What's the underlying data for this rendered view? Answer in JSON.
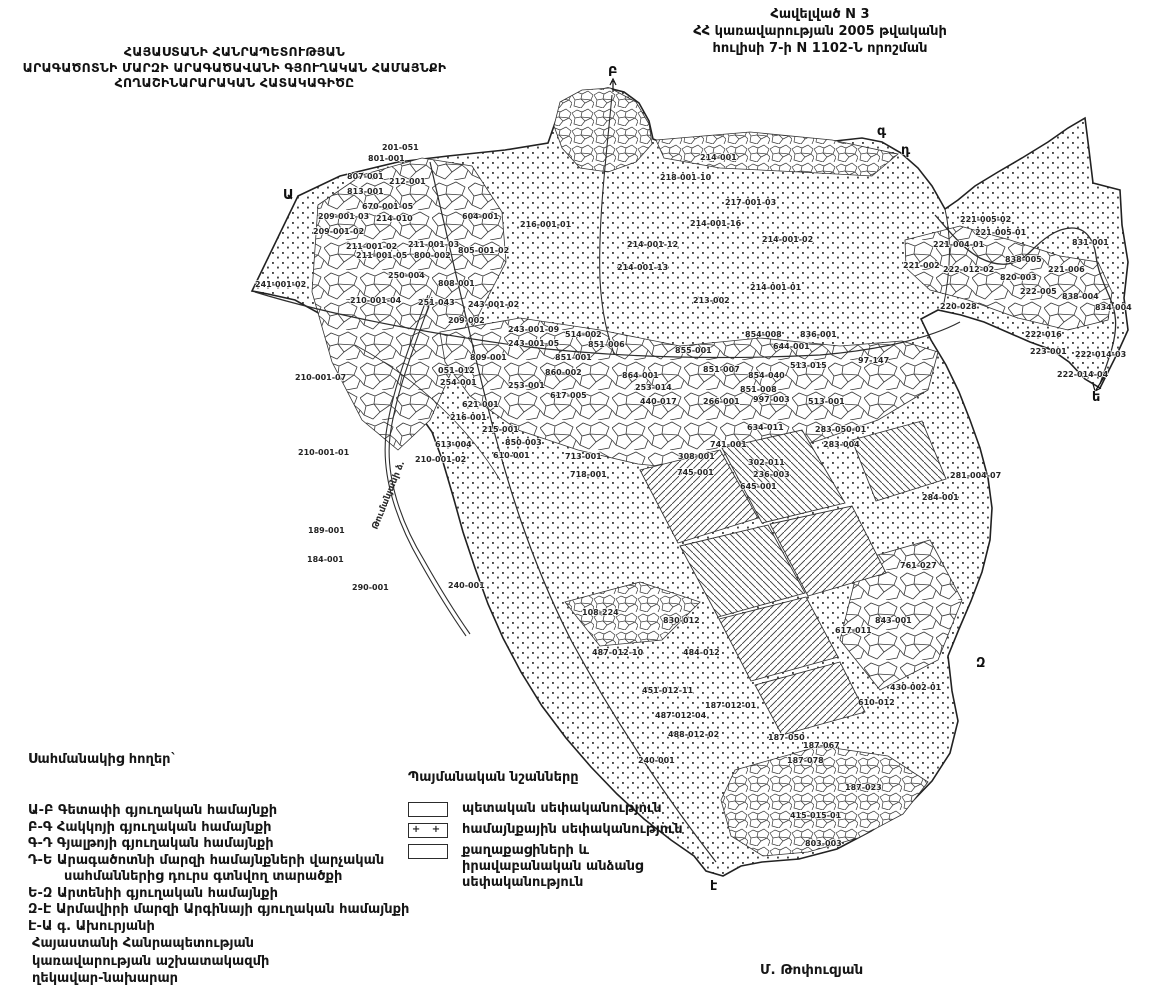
{
  "header_right": {
    "line1": "Հավելված N 3",
    "line2": "ՀՀ կառավարության 2005 թվականի",
    "line3": "հուլիսի 7-ի N 1102-Ն որոշման"
  },
  "header_left": {
    "line1": "ՀԱՅԱՍՏԱՆԻ ՀԱՆՐԱՊԵՏՈՒԹՅԱՆ",
    "line2": "ԱՐԱԳԱԾՈՏՆԻ ՄԱՐԶԻ ԱՐԱԳԱԾԱՎԱՆԻ ԳՅՈՒՂԱԿԱՆ ՀԱՄԱՅՆՔԻ",
    "line3": "ՀՈՂԱՇԻՆԱՐԱՐԱԿԱՆ ՀԱՏԱԿԱԳԻԾԸ"
  },
  "adjacent_lands": {
    "title": "Սահմանակից հողեր`",
    "items": [
      {
        "code": "Ա-Բ",
        "text": "Գետափի գյուղական համայնքի"
      },
      {
        "code": "Բ-Գ",
        "text": "Հակկոյի գյուղական համայնքի"
      },
      {
        "code": "Գ-Դ",
        "text": "Գյալթոյի գյուղական համայնքի"
      },
      {
        "code": "Դ-Ե",
        "text": "Արագածոտնի մարզի համայնքների վարչական սահմաններից դուրս գտնվող տարածքի"
      },
      {
        "code": "Ե-Զ",
        "text": "Արտենիի գյուղական համայնքի"
      },
      {
        "code": "Զ-Է",
        "text": "Արմավիրի մարզի Արգինայի գյուղական համայնքի"
      },
      {
        "code": "Է-Ա",
        "text": "գ. Ախուրյանի"
      }
    ]
  },
  "legend": {
    "title": "Պայմանական նշանները",
    "items": [
      {
        "symbol": "empty-box",
        "plus": "",
        "label": "պետական սեփականություն"
      },
      {
        "symbol": "plus-box",
        "plus": "+ +",
        "label": "համայնքային սեփականություն"
      },
      {
        "symbol": "empty-box",
        "plus": "",
        "label": "քաղաքացիների և իրավաբանական անձանց սեփականություն"
      }
    ]
  },
  "footer": {
    "line1": "Հայաստանի Հանրապետության",
    "line2": "կառավարության աշխատակազմի",
    "line3": "ղեկավար-նախարար"
  },
  "signature": "Մ. Թոփուզյան",
  "map": {
    "canal_label": "Թումանյանի ձ.",
    "boundary_letters": [
      {
        "t": "Ա",
        "x": 283,
        "y": 199
      },
      {
        "t": "Բ",
        "x": 608,
        "y": 76
      },
      {
        "t": "գ",
        "x": 877,
        "y": 135
      },
      {
        "t": "դ",
        "x": 901,
        "y": 154
      },
      {
        "t": "ե",
        "x": 1092,
        "y": 401
      },
      {
        "t": "Զ",
        "x": 976,
        "y": 667
      },
      {
        "t": "է",
        "x": 710,
        "y": 890
      }
    ],
    "parcel_labels": [
      {
        "x": 382,
        "y": 150,
        "t": "201-051"
      },
      {
        "x": 368,
        "y": 161,
        "t": "801-001"
      },
      {
        "x": 347,
        "y": 179,
        "t": "807-001"
      },
      {
        "x": 389,
        "y": 184,
        "t": "212-001"
      },
      {
        "x": 347,
        "y": 194,
        "t": "813-001"
      },
      {
        "x": 318,
        "y": 219,
        "t": "209-001-03"
      },
      {
        "x": 313,
        "y": 234,
        "t": "209-001-02"
      },
      {
        "x": 362,
        "y": 209,
        "t": "670-001-05"
      },
      {
        "x": 376,
        "y": 221,
        "t": "214-010"
      },
      {
        "x": 346,
        "y": 249,
        "t": "211-001-02"
      },
      {
        "x": 408,
        "y": 247,
        "t": "211-001-03"
      },
      {
        "x": 356,
        "y": 258,
        "t": "211-001-05"
      },
      {
        "x": 414,
        "y": 258,
        "t": "800-002"
      },
      {
        "x": 458,
        "y": 253,
        "t": "805-001-02"
      },
      {
        "x": 388,
        "y": 278,
        "t": "250-004"
      },
      {
        "x": 438,
        "y": 286,
        "t": "808-001"
      },
      {
        "x": 462,
        "y": 219,
        "t": "604-001"
      },
      {
        "x": 520,
        "y": 227,
        "t": "216-001-01"
      },
      {
        "x": 255,
        "y": 287,
        "t": "241-001-02"
      },
      {
        "x": 350,
        "y": 303,
        "t": "210-001-04"
      },
      {
        "x": 295,
        "y": 380,
        "t": "210-001-07"
      },
      {
        "x": 415,
        "y": 462,
        "t": "210-001-02"
      },
      {
        "x": 298,
        "y": 455,
        "t": "210-001-01"
      },
      {
        "x": 700,
        "y": 160,
        "t": "214-001"
      },
      {
        "x": 660,
        "y": 180,
        "t": "218-001-10"
      },
      {
        "x": 725,
        "y": 205,
        "t": "217-001-03"
      },
      {
        "x": 690,
        "y": 226,
        "t": "214-001-16"
      },
      {
        "x": 762,
        "y": 242,
        "t": "214-001-02"
      },
      {
        "x": 750,
        "y": 290,
        "t": "214-001-01"
      },
      {
        "x": 693,
        "y": 303,
        "t": "213-002"
      },
      {
        "x": 627,
        "y": 247,
        "t": "214-001-12"
      },
      {
        "x": 617,
        "y": 270,
        "t": "214-001-13"
      },
      {
        "x": 418,
        "y": 305,
        "t": "251-043"
      },
      {
        "x": 468,
        "y": 307,
        "t": "243-001-02"
      },
      {
        "x": 448,
        "y": 323,
        "t": "209-002"
      },
      {
        "x": 508,
        "y": 332,
        "t": "243-001-09"
      },
      {
        "x": 508,
        "y": 346,
        "t": "243-001-05"
      },
      {
        "x": 470,
        "y": 360,
        "t": "809-001"
      },
      {
        "x": 555,
        "y": 360,
        "t": "851-001"
      },
      {
        "x": 438,
        "y": 373,
        "t": "051-012"
      },
      {
        "x": 440,
        "y": 385,
        "t": "254-001"
      },
      {
        "x": 508,
        "y": 388,
        "t": "253-001"
      },
      {
        "x": 545,
        "y": 375,
        "t": "860-002"
      },
      {
        "x": 550,
        "y": 398,
        "t": "617-005"
      },
      {
        "x": 462,
        "y": 407,
        "t": "621-001"
      },
      {
        "x": 450,
        "y": 420,
        "t": "216-001"
      },
      {
        "x": 482,
        "y": 432,
        "t": "215-001"
      },
      {
        "x": 505,
        "y": 445,
        "t": "850-003"
      },
      {
        "x": 493,
        "y": 458,
        "t": "610-001"
      },
      {
        "x": 435,
        "y": 447,
        "t": "613-004"
      },
      {
        "x": 565,
        "y": 337,
        "t": "514-002"
      },
      {
        "x": 588,
        "y": 347,
        "t": "851-006"
      },
      {
        "x": 675,
        "y": 353,
        "t": "855-001"
      },
      {
        "x": 745,
        "y": 337,
        "t": "854-008"
      },
      {
        "x": 800,
        "y": 337,
        "t": "836-001"
      },
      {
        "x": 773,
        "y": 349,
        "t": "644-001"
      },
      {
        "x": 790,
        "y": 368,
        "t": "513-015"
      },
      {
        "x": 858,
        "y": 363,
        "t": "97-147"
      },
      {
        "x": 703,
        "y": 372,
        "t": "851-007"
      },
      {
        "x": 748,
        "y": 378,
        "t": "854-040"
      },
      {
        "x": 740,
        "y": 392,
        "t": "851-008"
      },
      {
        "x": 622,
        "y": 378,
        "t": "864-001"
      },
      {
        "x": 635,
        "y": 390,
        "t": "253-014"
      },
      {
        "x": 640,
        "y": 404,
        "t": "440-017"
      },
      {
        "x": 703,
        "y": 404,
        "t": "266-001"
      },
      {
        "x": 753,
        "y": 402,
        "t": "997-003"
      },
      {
        "x": 808,
        "y": 404,
        "t": "513-001"
      },
      {
        "x": 815,
        "y": 432,
        "t": "283-050-01"
      },
      {
        "x": 747,
        "y": 430,
        "t": "634-011"
      },
      {
        "x": 823,
        "y": 447,
        "t": "283-004"
      },
      {
        "x": 710,
        "y": 447,
        "t": "741-001"
      },
      {
        "x": 748,
        "y": 465,
        "t": "302-011"
      },
      {
        "x": 678,
        "y": 459,
        "t": "308-001"
      },
      {
        "x": 565,
        "y": 459,
        "t": "713-001"
      },
      {
        "x": 570,
        "y": 477,
        "t": "718-001"
      },
      {
        "x": 677,
        "y": 475,
        "t": "745-001"
      },
      {
        "x": 753,
        "y": 477,
        "t": "236-003"
      },
      {
        "x": 740,
        "y": 489,
        "t": "645-001"
      },
      {
        "x": 308,
        "y": 533,
        "t": "189-001"
      },
      {
        "x": 307,
        "y": 562,
        "t": "184-001"
      },
      {
        "x": 352,
        "y": 590,
        "t": "290-001"
      },
      {
        "x": 448,
        "y": 588,
        "t": "240-001"
      },
      {
        "x": 582,
        "y": 615,
        "t": "108-224"
      },
      {
        "x": 663,
        "y": 623,
        "t": "830-012"
      },
      {
        "x": 592,
        "y": 655,
        "t": "487-012-10"
      },
      {
        "x": 683,
        "y": 655,
        "t": "484-012"
      },
      {
        "x": 642,
        "y": 693,
        "t": "451-012-11"
      },
      {
        "x": 705,
        "y": 708,
        "t": "187-012-01"
      },
      {
        "x": 655,
        "y": 718,
        "t": "487-012-04"
      },
      {
        "x": 668,
        "y": 737,
        "t": "488-012-02"
      },
      {
        "x": 638,
        "y": 763,
        "t": "240-001"
      },
      {
        "x": 768,
        "y": 740,
        "t": "187-050"
      },
      {
        "x": 803,
        "y": 748,
        "t": "187-067"
      },
      {
        "x": 787,
        "y": 763,
        "t": "187-078"
      },
      {
        "x": 858,
        "y": 705,
        "t": "610-012"
      },
      {
        "x": 835,
        "y": 633,
        "t": "617-011"
      },
      {
        "x": 875,
        "y": 623,
        "t": "843-001"
      },
      {
        "x": 950,
        "y": 478,
        "t": "281-004-07"
      },
      {
        "x": 922,
        "y": 500,
        "t": "284-001"
      },
      {
        "x": 900,
        "y": 568,
        "t": "761-027"
      },
      {
        "x": 890,
        "y": 690,
        "t": "430-002-01"
      },
      {
        "x": 845,
        "y": 790,
        "t": "187-023"
      },
      {
        "x": 790,
        "y": 818,
        "t": "415-015-01"
      },
      {
        "x": 805,
        "y": 846,
        "t": "803-003"
      },
      {
        "x": 960,
        "y": 222,
        "t": "221-005-02"
      },
      {
        "x": 975,
        "y": 235,
        "t": "221-005-01"
      },
      {
        "x": 933,
        "y": 247,
        "t": "221-004-01"
      },
      {
        "x": 1005,
        "y": 262,
        "t": "838-005"
      },
      {
        "x": 1048,
        "y": 272,
        "t": "221-006"
      },
      {
        "x": 1072,
        "y": 245,
        "t": "831-001"
      },
      {
        "x": 903,
        "y": 268,
        "t": "221-002"
      },
      {
        "x": 943,
        "y": 272,
        "t": "222-012-02"
      },
      {
        "x": 1000,
        "y": 280,
        "t": "820-003"
      },
      {
        "x": 1020,
        "y": 294,
        "t": "222-005"
      },
      {
        "x": 1062,
        "y": 299,
        "t": "838-004"
      },
      {
        "x": 940,
        "y": 309,
        "t": "220-028"
      },
      {
        "x": 1095,
        "y": 310,
        "t": "834-004"
      },
      {
        "x": 1025,
        "y": 337,
        "t": "222-016"
      },
      {
        "x": 1030,
        "y": 354,
        "t": "223-001"
      },
      {
        "x": 1075,
        "y": 357,
        "t": "222-014-03"
      },
      {
        "x": 1057,
        "y": 377,
        "t": "222-014-04"
      }
    ]
  }
}
